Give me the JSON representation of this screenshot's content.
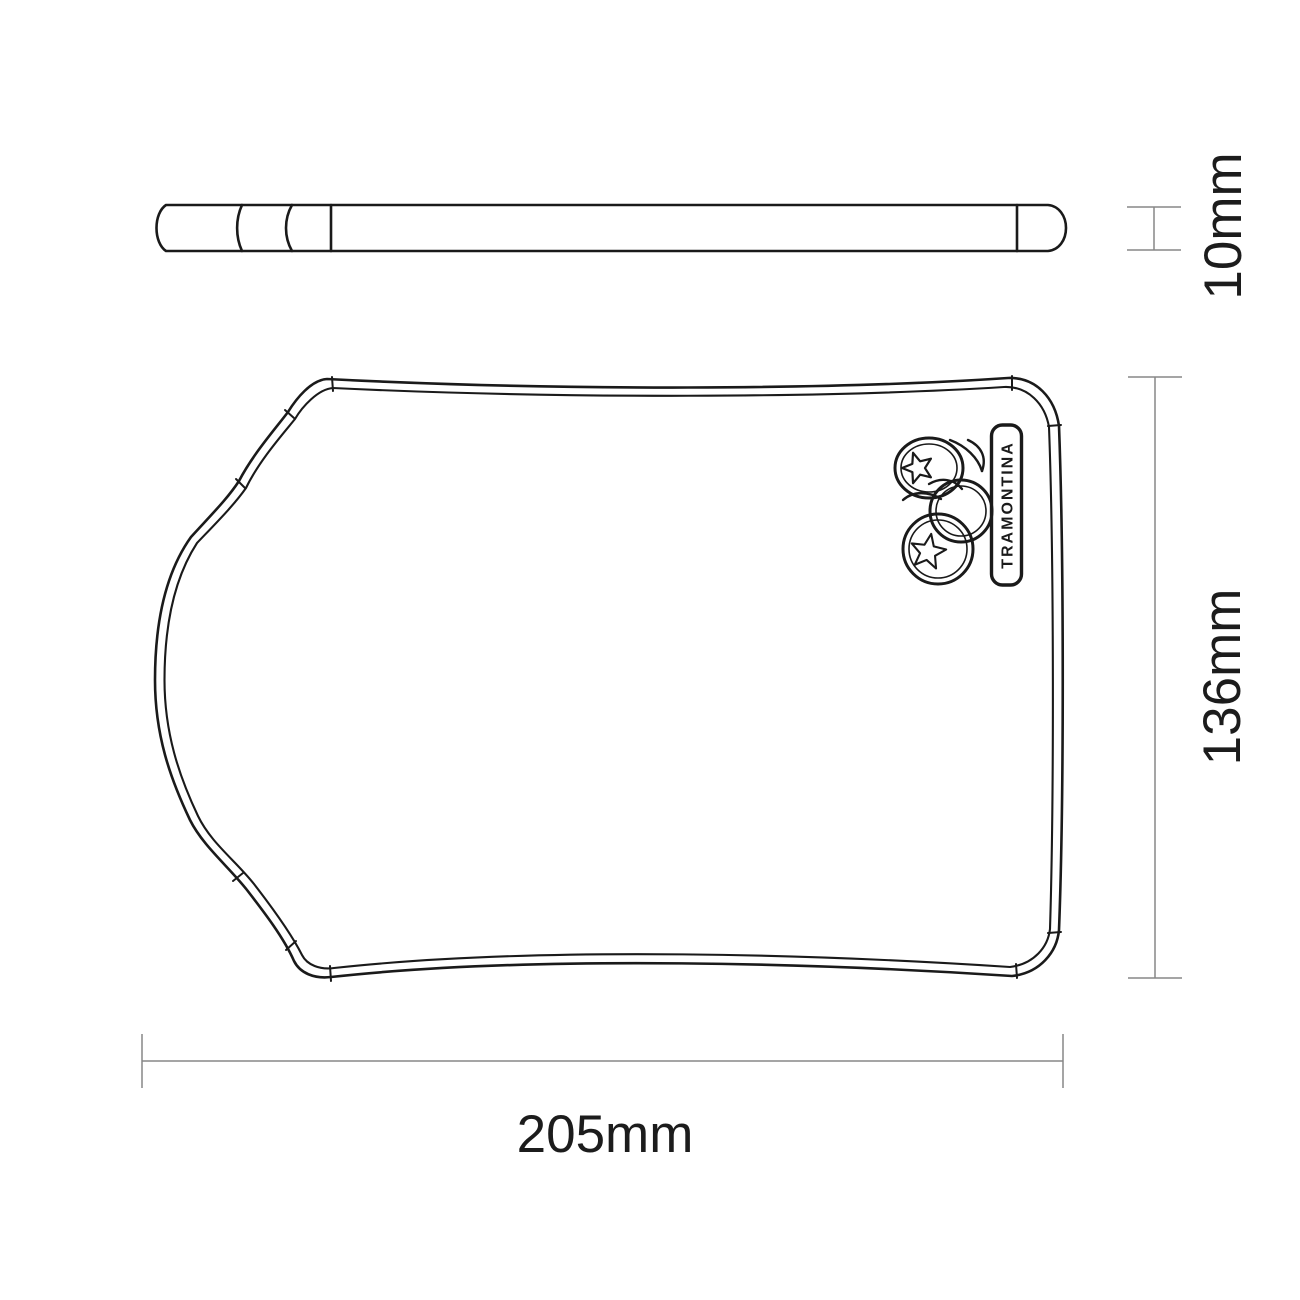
{
  "drawing": {
    "colors": {
      "outline": "#1a1a1a",
      "dimension_lines": "#878787",
      "labels": "#1c1c1c",
      "background": "#ffffff"
    },
    "dimension_labels": {
      "thickness": "10mm",
      "height": "136mm",
      "width": "205mm"
    },
    "branding": {
      "badge_text": "TRAMONTINA",
      "icon": "tomatoes-line-art-icon"
    }
  }
}
